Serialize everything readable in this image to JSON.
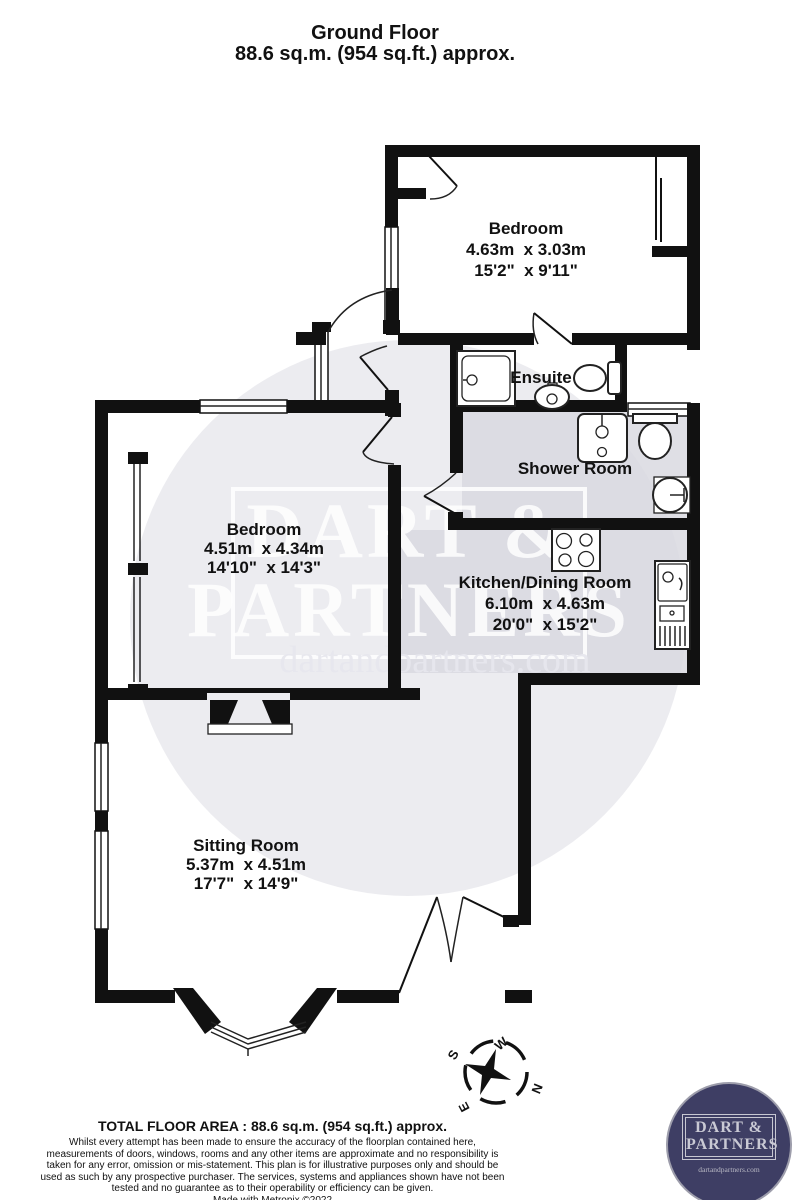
{
  "title": {
    "line1": "Ground Floor",
    "line2": "88.6 sq.m. (954 sq.ft.) approx."
  },
  "rooms": {
    "bedroom_top": {
      "name": "Bedroom",
      "metric": "4.63m  x 3.03m",
      "imperial": "15'2\"  x 9'11\""
    },
    "bedroom_left": {
      "name": "Bedroom",
      "metric": "4.51m  x 4.34m",
      "imperial": "14'10\"  x 14'3\""
    },
    "ensuite": {
      "name": "Ensuite"
    },
    "shower_room": {
      "name": "Shower Room"
    },
    "kitchen": {
      "name": "Kitchen/Dining Room",
      "metric": "6.10m  x 4.63m",
      "imperial": "20'0\"  x 15'2\""
    },
    "sitting_room": {
      "name": "Sitting Room",
      "metric": "5.37m  x 4.51m",
      "imperial": "17'7\"  x 14'9\""
    }
  },
  "watermark": {
    "line1": "DART &",
    "line2": "PARTNERS",
    "url": "dartandpartners.com"
  },
  "compass": {
    "n": "N",
    "s": "S",
    "e": "E",
    "w": "W"
  },
  "footer": {
    "total": "TOTAL FLOOR AREA : 88.6 sq.m. (954 sq.ft.) approx.",
    "disclaimer": "Whilst every attempt has been made to ensure the accuracy of the floorplan contained here, measurements of doors, windows, rooms and any other items are approximate and no responsibility is taken for any error, omission or mis-statement. This plan is for illustrative purposes only and should be used as such by any prospective purchaser. The services, systems and appliances shown have not been tested and no guarantee as to their operability or efficiency can be given.",
    "credit": "Made with Metropix ©2022"
  },
  "logo": {
    "line1": "DART &",
    "line2": "PARTNERS",
    "url": "dartandpartners.com"
  },
  "colors": {
    "wall": "#111111",
    "floor_gray": "#dfdfe5",
    "watermark_gray": "#d9d9e2",
    "logo_navy": "#3e3e64",
    "logo_silver": "#c9c9d4"
  }
}
